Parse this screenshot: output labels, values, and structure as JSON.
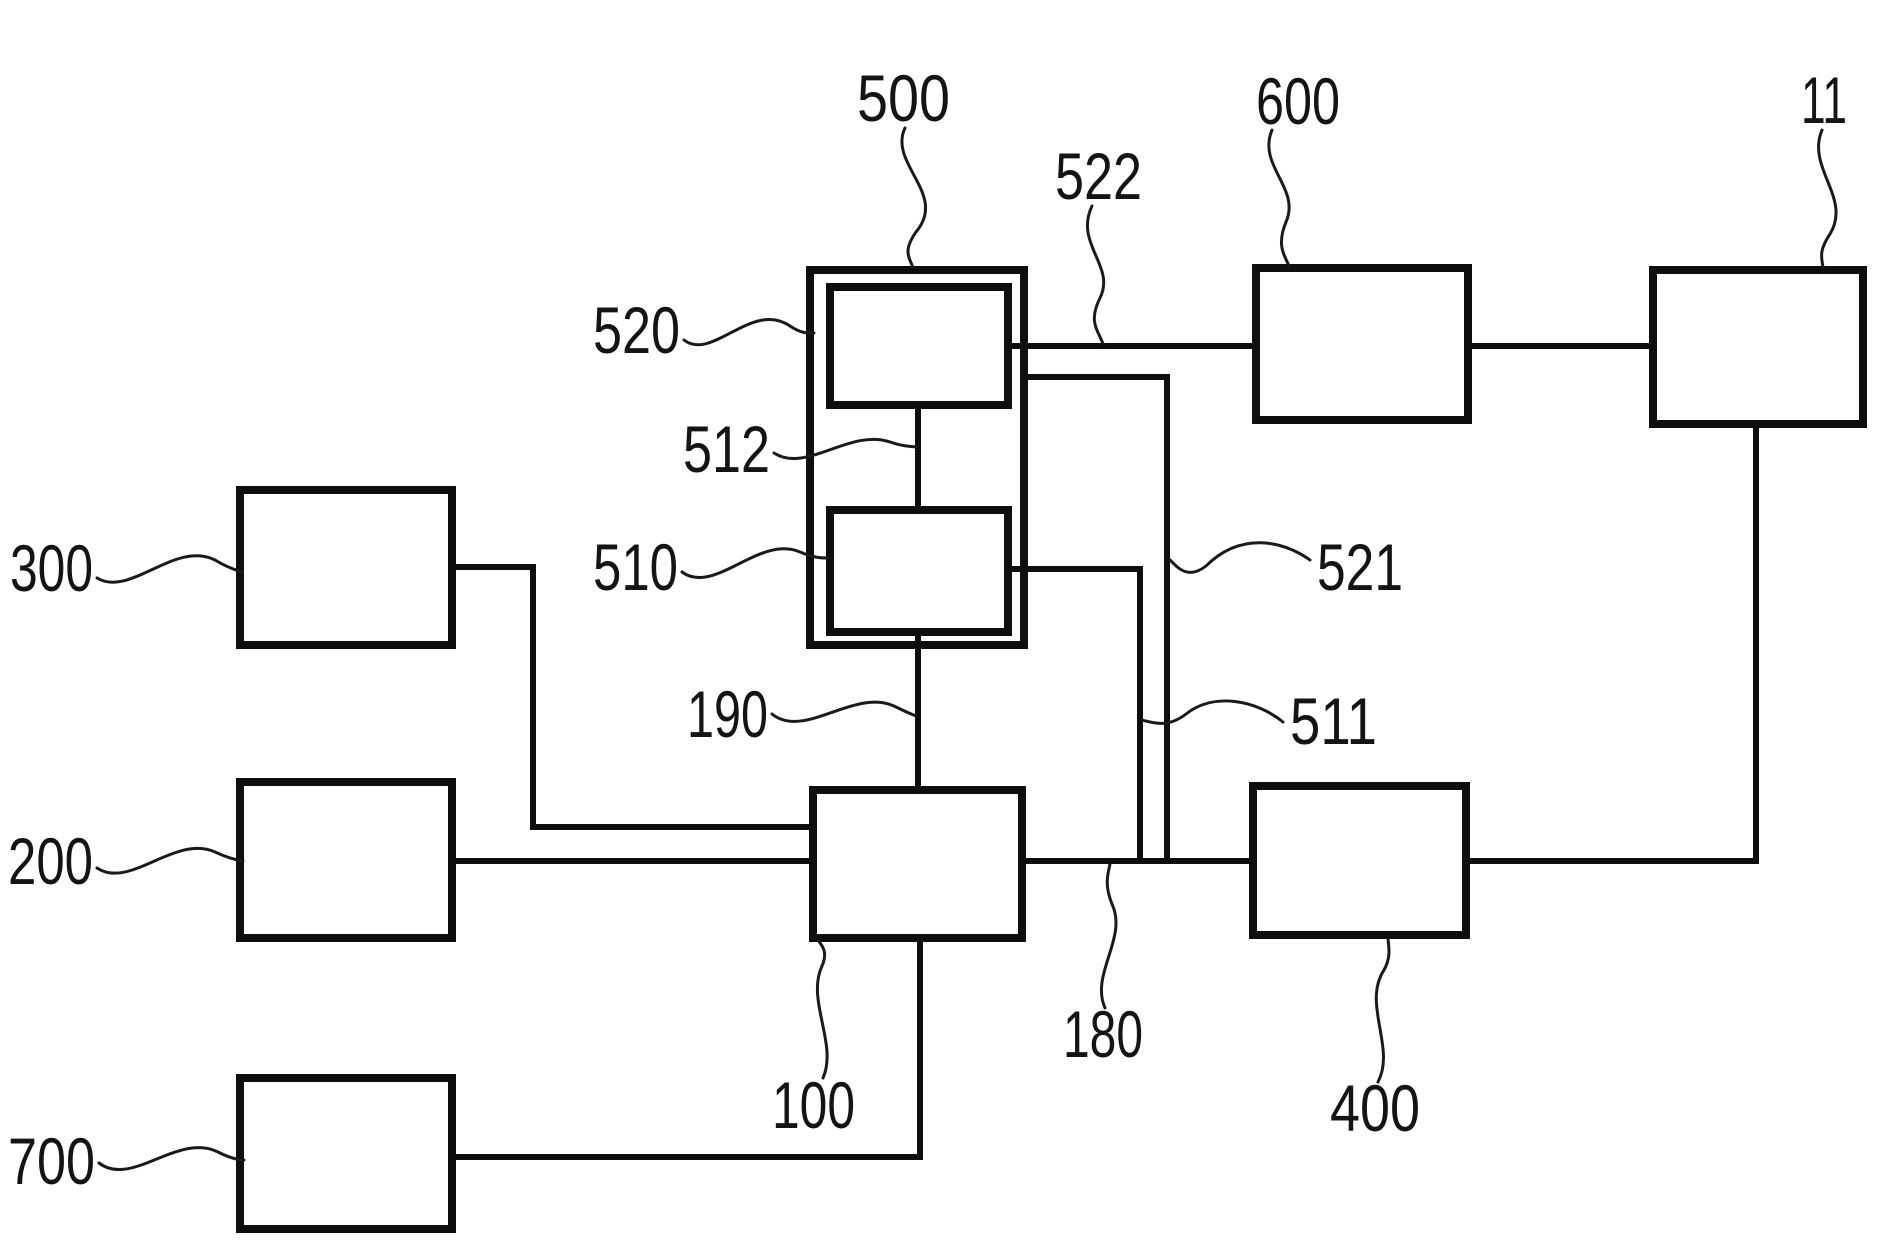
{
  "figure": {
    "width": 1877,
    "height": 1242,
    "background_color": "#ffffff",
    "ink_color": "#0e0e0e",
    "type": "patent-block-diagram"
  },
  "boxes": [
    {
      "id": "500-group",
      "kind": "group",
      "x": 810,
      "y": 270,
      "w": 214,
      "h": 375
    },
    {
      "id": "520",
      "kind": "node",
      "x": 830,
      "y": 287,
      "w": 178,
      "h": 118
    },
    {
      "id": "510",
      "kind": "node",
      "x": 830,
      "y": 510,
      "w": 178,
      "h": 122
    },
    {
      "id": "600",
      "kind": "node",
      "x": 1256,
      "y": 268,
      "w": 212,
      "h": 152
    },
    {
      "id": "11",
      "kind": "node",
      "x": 1653,
      "y": 270,
      "w": 210,
      "h": 154
    },
    {
      "id": "300",
      "kind": "node",
      "x": 240,
      "y": 490,
      "w": 212,
      "h": 155
    },
    {
      "id": "200",
      "kind": "node",
      "x": 240,
      "y": 782,
      "w": 212,
      "h": 156
    },
    {
      "id": "700",
      "kind": "node",
      "x": 240,
      "y": 1078,
      "w": 212,
      "h": 151
    },
    {
      "id": "100",
      "kind": "node",
      "x": 813,
      "y": 790,
      "w": 209,
      "h": 148
    },
    {
      "id": "400",
      "kind": "node",
      "x": 1253,
      "y": 786,
      "w": 213,
      "h": 149
    }
  ],
  "connectors": [
    {
      "id": "520-to-600",
      "points": [
        [
          1008,
          346
        ],
        [
          1256,
          346
        ]
      ]
    },
    {
      "id": "600-to-11",
      "points": [
        [
          1468,
          346
        ],
        [
          1653,
          346
        ]
      ]
    },
    {
      "id": "500-down-bus-521",
      "points": [
        [
          1024,
          377
        ],
        [
          1167,
          377
        ],
        [
          1167,
          861
        ]
      ]
    },
    {
      "id": "510-down-bus-511",
      "points": [
        [
          1008,
          569
        ],
        [
          1140,
          569
        ],
        [
          1140,
          861
        ]
      ]
    },
    {
      "id": "520-to-510-512",
      "points": [
        [
          918,
          405
        ],
        [
          918,
          510
        ]
      ]
    },
    {
      "id": "510-to-100-190",
      "points": [
        [
          918,
          632
        ],
        [
          918,
          790
        ]
      ]
    },
    {
      "id": "200-to-100",
      "points": [
        [
          452,
          861
        ],
        [
          813,
          861
        ]
      ]
    },
    {
      "id": "100-to-400-180",
      "points": [
        [
          1022,
          861
        ],
        [
          1253,
          861
        ]
      ]
    },
    {
      "id": "400-to-11",
      "points": [
        [
          1466,
          861
        ],
        [
          1756,
          861
        ],
        [
          1756,
          424
        ]
      ]
    },
    {
      "id": "300-to-100",
      "points": [
        [
          452,
          567
        ],
        [
          533,
          567
        ],
        [
          533,
          827
        ],
        [
          813,
          827
        ]
      ]
    },
    {
      "id": "700-to-100",
      "points": [
        [
          452,
          1157
        ],
        [
          920,
          1157
        ],
        [
          920,
          938
        ]
      ]
    }
  ],
  "callouts": [
    {
      "text": "500",
      "tx": 857,
      "ty": 121,
      "len": 93,
      "leader": "M905 128 C888 164 948 194 916 232 C902 252 910 258 913 268"
    },
    {
      "text": "522",
      "tx": 1055,
      "ty": 199,
      "len": 87,
      "leader": "M1092 206 C1074 244 1116 266 1100 298 C1088 322 1098 330 1103 344"
    },
    {
      "text": "600",
      "tx": 1256,
      "ty": 124,
      "len": 84,
      "leader": "M1272 130 C1257 166 1301 188 1286 222 C1276 246 1285 256 1289 266"
    },
    {
      "text": "11",
      "tx": 1801,
      "ty": 123,
      "len": 46,
      "leader": "M1822 130 C1806 168 1852 198 1830 234 C1818 252 1822 258 1823 268"
    },
    {
      "text": "520",
      "tx": 593,
      "ty": 353,
      "len": 87,
      "leader": "M684 340 C712 362 752 300 790 326 C802 334 808 333 814 333"
    },
    {
      "text": "512",
      "tx": 683,
      "ty": 472,
      "len": 87,
      "leader": "M774 453 C806 474 850 428 890 442 C904 447 910 446 916 447"
    },
    {
      "text": "510",
      "tx": 593,
      "ty": 590,
      "len": 85,
      "leader": "M682 572 C714 596 760 534 800 552 C814 558 822 558 828 558"
    },
    {
      "text": "190",
      "tx": 687,
      "ty": 737,
      "len": 81,
      "leader": "M772 714 C804 740 854 688 894 706 C906 712 911 714 916 716"
    },
    {
      "text": "521",
      "tx": 1317,
      "ty": 590,
      "len": 86,
      "leader": "M1310 560 C1282 540 1240 532 1206 566 C1188 580 1178 568 1170 560"
    },
    {
      "text": "511",
      "tx": 1290,
      "ty": 744,
      "len": 87,
      "leader": "M1283 722 C1256 700 1214 692 1186 714 C1168 728 1154 723 1142 720"
    },
    {
      "text": "300",
      "tx": 10,
      "ty": 591,
      "len": 83,
      "leader": "M97 578 C130 598 175 540 215 560 C228 568 236 570 242 572"
    },
    {
      "text": "200",
      "tx": 8,
      "ty": 884,
      "len": 85,
      "leader": "M97 868 C130 890 175 834 215 852 C228 858 236 860 243 861"
    },
    {
      "text": "700",
      "tx": 8,
      "ty": 1184,
      "len": 87,
      "leader": "M99 1163 C132 1188 178 1132 218 1152 C230 1158 238 1160 244 1160"
    },
    {
      "text": "100",
      "tx": 772,
      "ty": 1128,
      "len": 83,
      "leader": "M823 1078 C838 1044 806 1000 822 966 C829 950 820 944 818 940"
    },
    {
      "text": "180",
      "tx": 1063,
      "ty": 1057,
      "len": 80,
      "leader": "M1105 1008 C1090 974 1128 938 1112 904 C1104 884 1108 874 1110 864"
    },
    {
      "text": "400",
      "tx": 1330,
      "ty": 1131,
      "len": 90,
      "leader": "M1378 1082 C1396 1048 1362 1004 1384 970 C1392 956 1388 944 1388 938"
    }
  ]
}
